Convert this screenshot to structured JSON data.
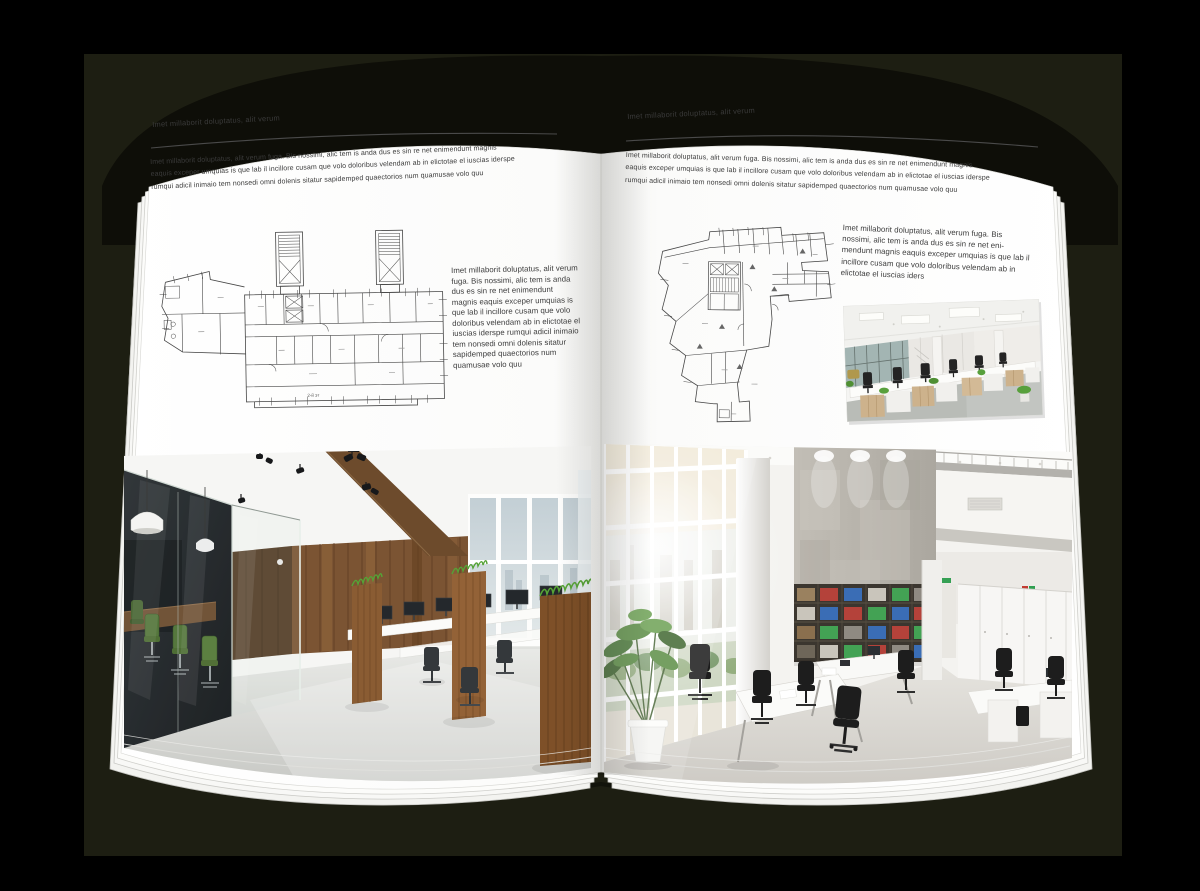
{
  "colors": {
    "backdrop": "#000000",
    "shadow_panel": "#1d1e12",
    "cover": "#0e0e08",
    "page": "#ffffff",
    "body_text": "#3b3b3b",
    "rule": "#4a4a4a",
    "plan_line": "#474747",
    "wood": "#7b5433",
    "plant_green": "#55a336"
  },
  "left_page": {
    "header": "Imet millaborit doluptatus, alit verum",
    "intro_lines": [
      "Imet millaborit doluptatus, alit verum fuga. Bis nossimi, alic tem is anda dus es sin re net enimendunt magnis",
      "eaquis exceper umquias is que lab il incillore cusam que volo doloribus velendam ab in elictotae el iuscias iderspe",
      "rumqui adicil inimaio tem nonsedi omni dolenis sitatur sapidemped quaectorios num quamusae volo quu"
    ],
    "side_text": "Imet millaborit doluptatus, alit verum fuga. Bis nossimi, alic tem is anda dus es sin re net enimendunt magnis eaquis exceper umquias is que lab il incillore cusam que volo doloribus velendam ab in elictotae el iuscias iderspe rumqui adicil inimaio tem nonsedi omni dolenis sitatur sapidemped quaectorios num quamusae volo quu",
    "plan_label": "2-й эт"
  },
  "right_page": {
    "header": "Imet millaborit doluptatus, alit verum",
    "intro_lines": [
      "Imet millaborit doluptatus, alit verum fuga. Bis nossimi, alic tem is anda dus es sin re net enimendunt magnis",
      "eaquis exceper umquias is que lab il incillore cusam que volo doloribus velendam ab in elictotae el iuscias iderspe",
      "rumqui adicil inimaio tem nonsedi omni dolenis sitatur sapidemped quaectorios num quamusae volo quu"
    ],
    "side_text": "Imet millaborit doluptatus, alit verum fuga. Bis nossimi, alic tem is anda dus es sin re net eni-mendunt magnis eaquis exceper umquias is que lab il incillore cusam que volo doloribus velendam ab in elictotae el iuscias iders"
  }
}
